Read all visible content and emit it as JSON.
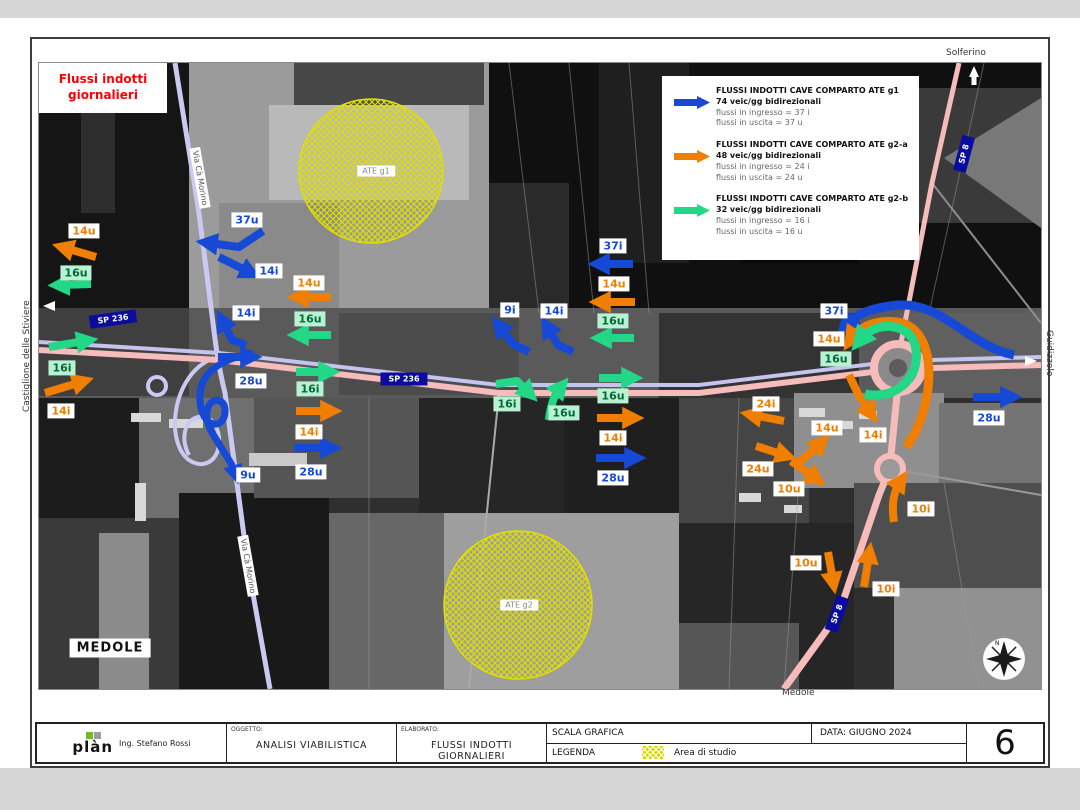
{
  "header_box": {
    "line1": "Flussi indotti",
    "line2": "giornalieri"
  },
  "legend": {
    "entries": [
      {
        "title": "FLUSSI INDOTTI CAVE COMPARTO ATE g1",
        "subtitle": "74 veic/gg bidirezionali",
        "line_in": "flussi in ingresso = 37 i",
        "line_out": "flussi in uscita = 37 u",
        "color": "#1549d6"
      },
      {
        "title": "FLUSSI INDOTTI CAVE COMPARTO ATE g2-a",
        "subtitle": "48 veic/gg bidirezionali",
        "line_in": "flussi in ingresso = 24 i",
        "line_out": "flussi in uscita = 24 u",
        "color": "#f07e00"
      },
      {
        "title": "FLUSSI INDOTTI CAVE COMPARTO ATE g2-b",
        "subtitle": "32 veic/gg bidirezionali",
        "line_in": "flussi in ingresso = 16 i",
        "line_out": "flussi in uscita = 16 u",
        "color": "#22d886"
      }
    ]
  },
  "map": {
    "place_labels": {
      "left": "Castiglione delle Stiviere",
      "top_right": "Solferino",
      "right": "Guidizzolo",
      "bottom": "Medole",
      "town_box": "MEDOLE"
    },
    "road_labels": {
      "sp236": "SP 236",
      "sp8": "SP 8",
      "via": "Via Cà Morino"
    },
    "area_labels": {
      "g1": "ATE g1",
      "g2": "ATE g2"
    },
    "compass": {
      "n": "N"
    },
    "colors": {
      "blue": "#1549d6",
      "orange": "#f07e00",
      "green": "#22d886",
      "green_label_bg": "#b9f2d2",
      "road_sign_bg": "#0b0b9e",
      "hatch_yellow": "#e0e000",
      "title_red": "#ff0000"
    },
    "flow_labels": [
      {
        "text": "37u",
        "type": "blue"
      },
      {
        "text": "14i",
        "type": "blue"
      },
      {
        "text": "14i",
        "type": "blue"
      },
      {
        "text": "28u",
        "type": "blue"
      },
      {
        "text": "9u",
        "type": "blue"
      },
      {
        "text": "28u",
        "type": "blue"
      },
      {
        "text": "9i",
        "type": "blue"
      },
      {
        "text": "14i",
        "type": "blue"
      },
      {
        "text": "37i",
        "type": "blue"
      },
      {
        "text": "28u",
        "type": "blue"
      },
      {
        "text": "37i",
        "type": "blue"
      },
      {
        "text": "28u",
        "type": "blue"
      },
      {
        "text": "14u",
        "type": "orange"
      },
      {
        "text": "14i",
        "type": "orange"
      },
      {
        "text": "14u",
        "type": "orange"
      },
      {
        "text": "14i",
        "type": "orange"
      },
      {
        "text": "14u",
        "type": "orange"
      },
      {
        "text": "14i",
        "type": "orange"
      },
      {
        "text": "14u",
        "type": "orange"
      },
      {
        "text": "24i",
        "type": "orange"
      },
      {
        "text": "14u",
        "type": "orange"
      },
      {
        "text": "14i",
        "type": "orange"
      },
      {
        "text": "24u",
        "type": "orange"
      },
      {
        "text": "10u",
        "type": "orange"
      },
      {
        "text": "10i",
        "type": "orange"
      },
      {
        "text": "10u",
        "type": "orange"
      },
      {
        "text": "10i",
        "type": "orange"
      },
      {
        "text": "16u",
        "type": "green"
      },
      {
        "text": "16i",
        "type": "green"
      },
      {
        "text": "16u",
        "type": "green"
      },
      {
        "text": "16i",
        "type": "green"
      },
      {
        "text": "16u",
        "type": "green"
      },
      {
        "text": "16u",
        "type": "green"
      },
      {
        "text": "16i",
        "type": "green"
      },
      {
        "text": "16u",
        "type": "green"
      },
      {
        "text": "16u",
        "type": "green"
      }
    ]
  },
  "titleblock": {
    "logo_word": "plàn",
    "logo_sub": "Ing. Stefano Rossi",
    "oggetto_label": "OGGETTO:",
    "oggetto_value": "ANALISI VIABILISTICA",
    "elaborato_label": "ELABORATO:",
    "elaborato_value": "FLUSSI INDOTTI GIORNALIERI",
    "scala_label": "SCALA GRAFICA",
    "data_label": "DATA: GIUGNO 2024",
    "legenda_label": "LEGENDA",
    "legenda_item": "Area di studio",
    "page_number": "6"
  }
}
